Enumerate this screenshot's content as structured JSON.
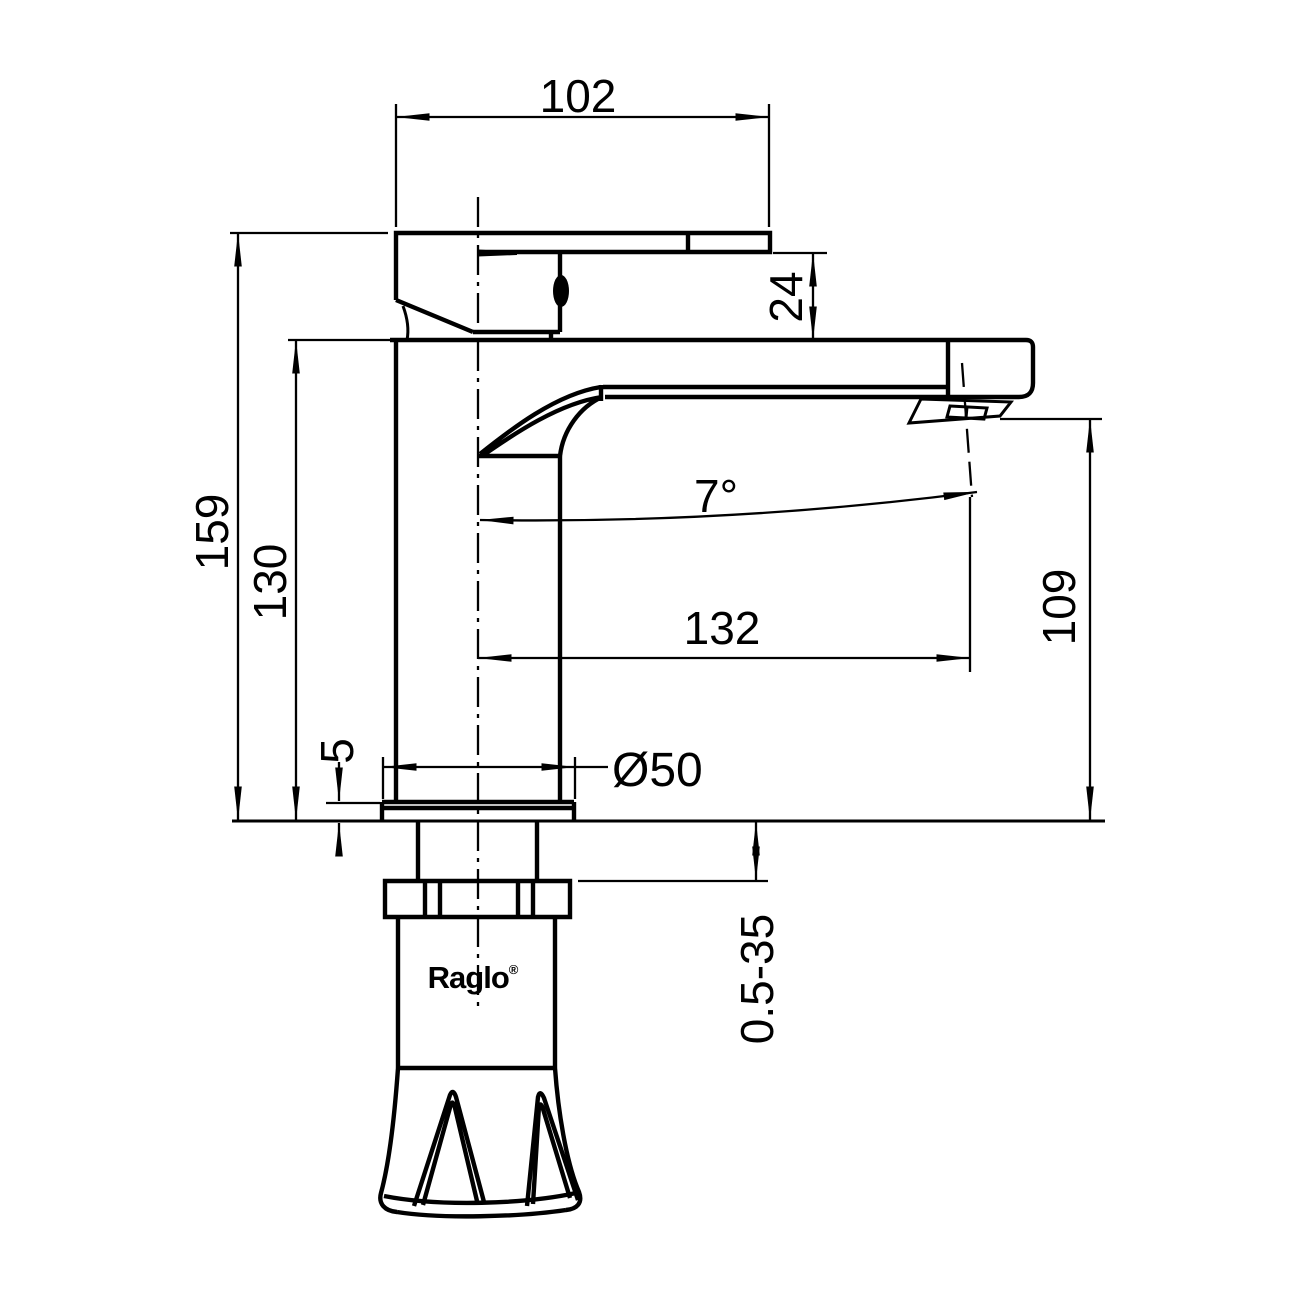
{
  "drawing": {
    "brand": "Raglo",
    "trademark_symbol": "®",
    "dimensions": {
      "handle_width": "102",
      "handle_clearance": "24",
      "overall_height": "159",
      "body_height": "130",
      "spout_angle": "7°",
      "spout_reach": "132",
      "outlet_height": "109",
      "base_diameter": "Ø50",
      "deck_plate_thickness": "5",
      "mounting_thickness_range": "0.5-35"
    }
  }
}
